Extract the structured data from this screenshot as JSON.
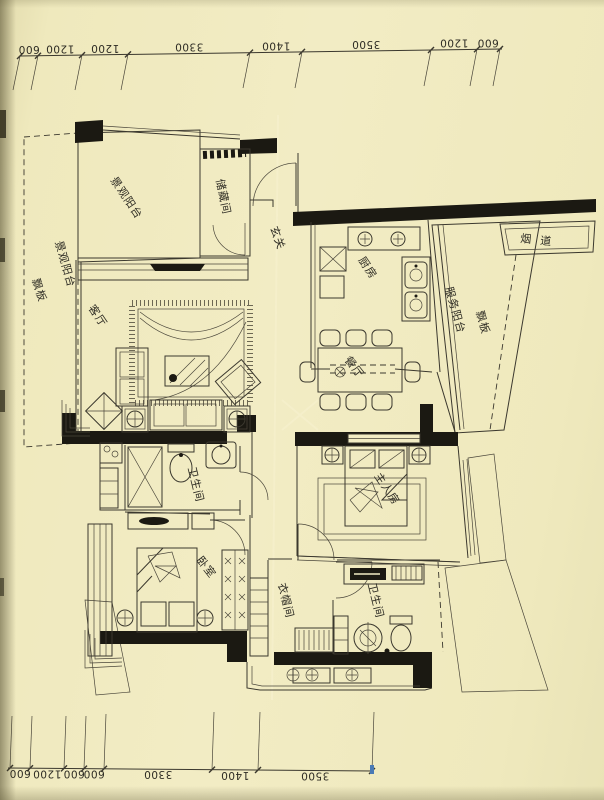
{
  "document": {
    "type": "scanned-apartment-floor-plan"
  },
  "colors": {
    "paper": "#f1ebc2",
    "ink": "#3b382e",
    "wall_fill": "#1b1912",
    "hatch": "#847e63",
    "blue_tick": "#4a7ab5"
  },
  "dimensions": {
    "top": {
      "values": [
        "600",
        "1200",
        "1200",
        "3300",
        "1400",
        "3500",
        "1200",
        "600"
      ]
    },
    "bottom": {
      "values": [
        "600",
        "1200",
        "600",
        "600",
        "3300",
        "1400",
        "3500"
      ]
    }
  },
  "rooms": [
    {
      "id": "piaoban-left",
      "label": "飘板"
    },
    {
      "id": "scenic-balcony-left",
      "label": "景观阳台"
    },
    {
      "id": "scenic-balcony-main",
      "label": "景观阳台"
    },
    {
      "id": "storage-room",
      "label": "储藏间"
    },
    {
      "id": "entry-hall",
      "label": "玄关"
    },
    {
      "id": "kitchen",
      "label": "厨房"
    },
    {
      "id": "flue",
      "label": "烟道"
    },
    {
      "id": "service-balcony",
      "label": "服务阳台"
    },
    {
      "id": "piaoban-right",
      "label": "飘板"
    },
    {
      "id": "living-room",
      "label": "客厅"
    },
    {
      "id": "dining-room",
      "label": "餐厅"
    },
    {
      "id": "bathroom-1",
      "label": "卫生间"
    },
    {
      "id": "master-bedroom",
      "label": "主人房"
    },
    {
      "id": "bedroom",
      "label": "卧室"
    },
    {
      "id": "cloakroom",
      "label": "衣帽间"
    },
    {
      "id": "bathroom-2",
      "label": "卫生间"
    }
  ]
}
